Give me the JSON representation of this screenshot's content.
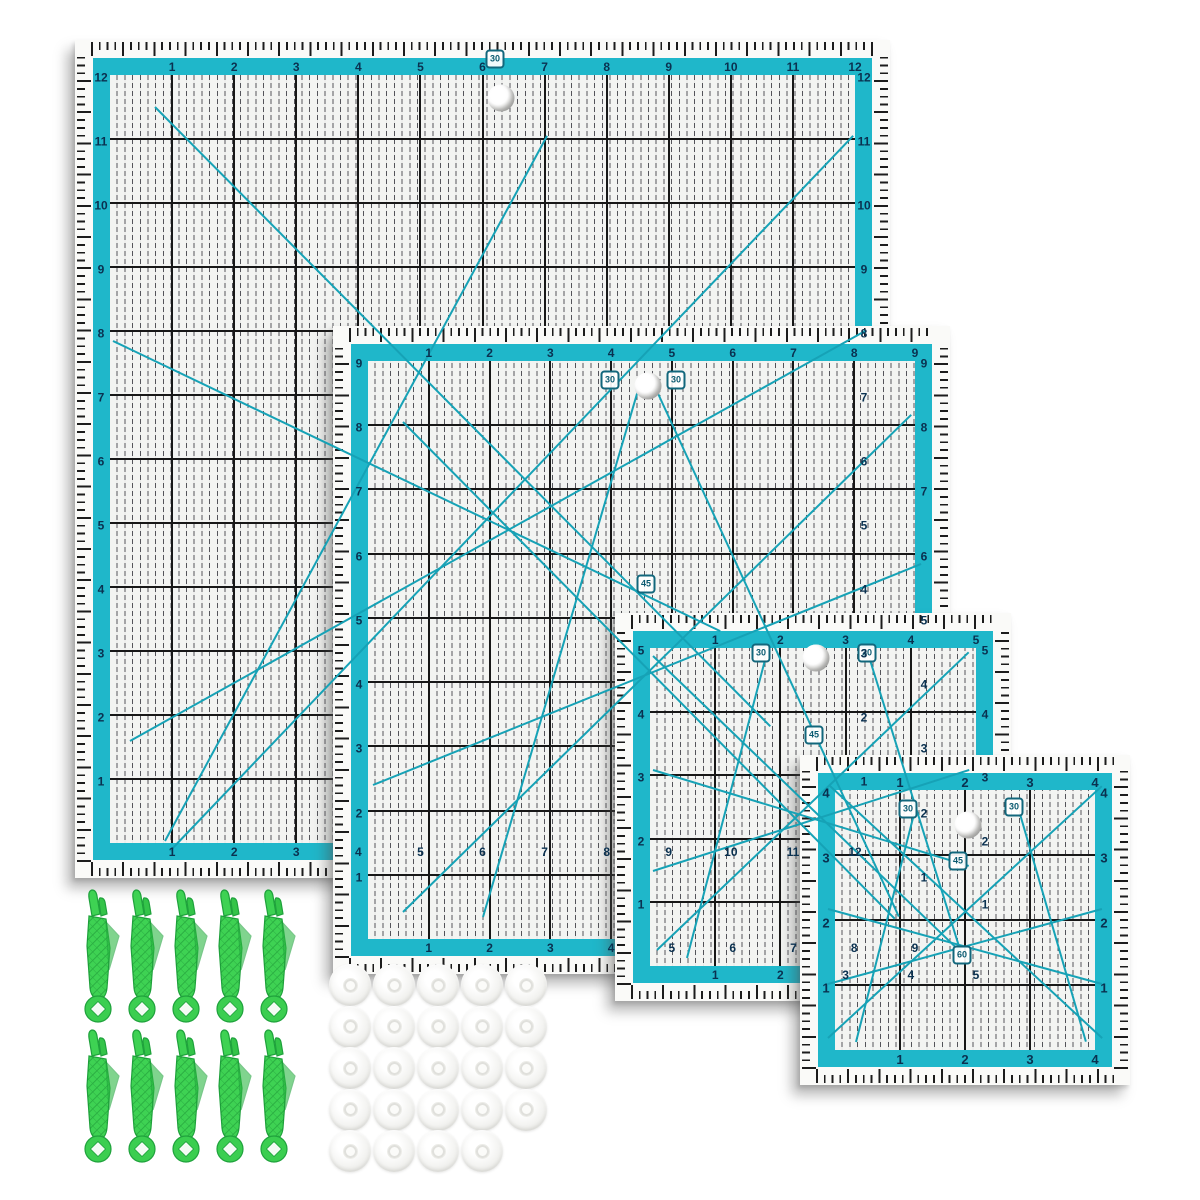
{
  "colors": {
    "teal": "#1fb7ca",
    "diagonal_teal": "#16a2b6",
    "grid_black": "#171717",
    "number_navy": "#0a3150",
    "badge_border": "#12677c",
    "clip_green": "#3ed253",
    "clip_green_dark": "#1fa23c",
    "disc_gray": "#dededa",
    "background": "#ffffff"
  },
  "rulers": [
    {
      "id": "ruler-large",
      "top_numbers": [
        "1",
        "2",
        "3",
        "4",
        "5",
        "6",
        "7",
        "8",
        "9",
        "10",
        "11",
        "12"
      ],
      "left_numbers": [
        "12",
        "11",
        "10",
        "9",
        "8",
        "7",
        "6",
        "5",
        "4",
        "3",
        "2",
        "1"
      ],
      "right_numbers": [
        "12",
        "11",
        "10",
        "9",
        "8",
        "7",
        "6",
        "5",
        "4",
        "3",
        "2",
        "1"
      ],
      "bottom_numbers": [
        "1",
        "2",
        "3",
        "4",
        "5",
        "6",
        "7",
        "8",
        "9",
        "10",
        "11",
        "12"
      ],
      "angle_markers": [
        "30"
      ]
    },
    {
      "id": "ruler-medium",
      "top_numbers": [
        "1",
        "2",
        "3",
        "4",
        "5",
        "6",
        "7",
        "8",
        "9"
      ],
      "left_numbers": [
        "9",
        "8",
        "7",
        "6",
        "5",
        "4",
        "3",
        "2",
        "1"
      ],
      "right_numbers": [
        "9",
        "8",
        "7",
        "6",
        "5",
        "4",
        "3",
        "2",
        "1"
      ],
      "bottom_numbers": [
        "1",
        "2",
        "3",
        "4",
        "5",
        "6",
        "7",
        "8",
        "9"
      ],
      "angle_markers": [
        "30",
        "30",
        "45"
      ]
    },
    {
      "id": "ruler-small",
      "top_numbers": [
        "1",
        "2",
        "3",
        "4",
        "5"
      ],
      "left_numbers": [
        "5",
        "4",
        "3",
        "2",
        "1"
      ],
      "right_numbers": [
        "5",
        "4",
        "3",
        "2",
        "1"
      ],
      "bottom_numbers": [
        "1",
        "2",
        "3",
        "4",
        "5"
      ],
      "angle_markers": [
        "30",
        "30",
        "45"
      ]
    },
    {
      "id": "ruler-mini",
      "top_numbers": [
        "1",
        "2",
        "3",
        "4"
      ],
      "left_numbers": [
        "4",
        "3",
        "2",
        "1"
      ],
      "right_numbers": [
        "4",
        "3",
        "2",
        "1"
      ],
      "bottom_numbers": [
        "1",
        "2",
        "3",
        "4"
      ],
      "angle_markers": [
        "30",
        "30",
        "45",
        "60"
      ]
    }
  ],
  "clips": {
    "count": 10,
    "rows": [
      5,
      5
    ]
  },
  "discs": {
    "count": 24,
    "rows": [
      5,
      5,
      5,
      5,
      4
    ]
  }
}
